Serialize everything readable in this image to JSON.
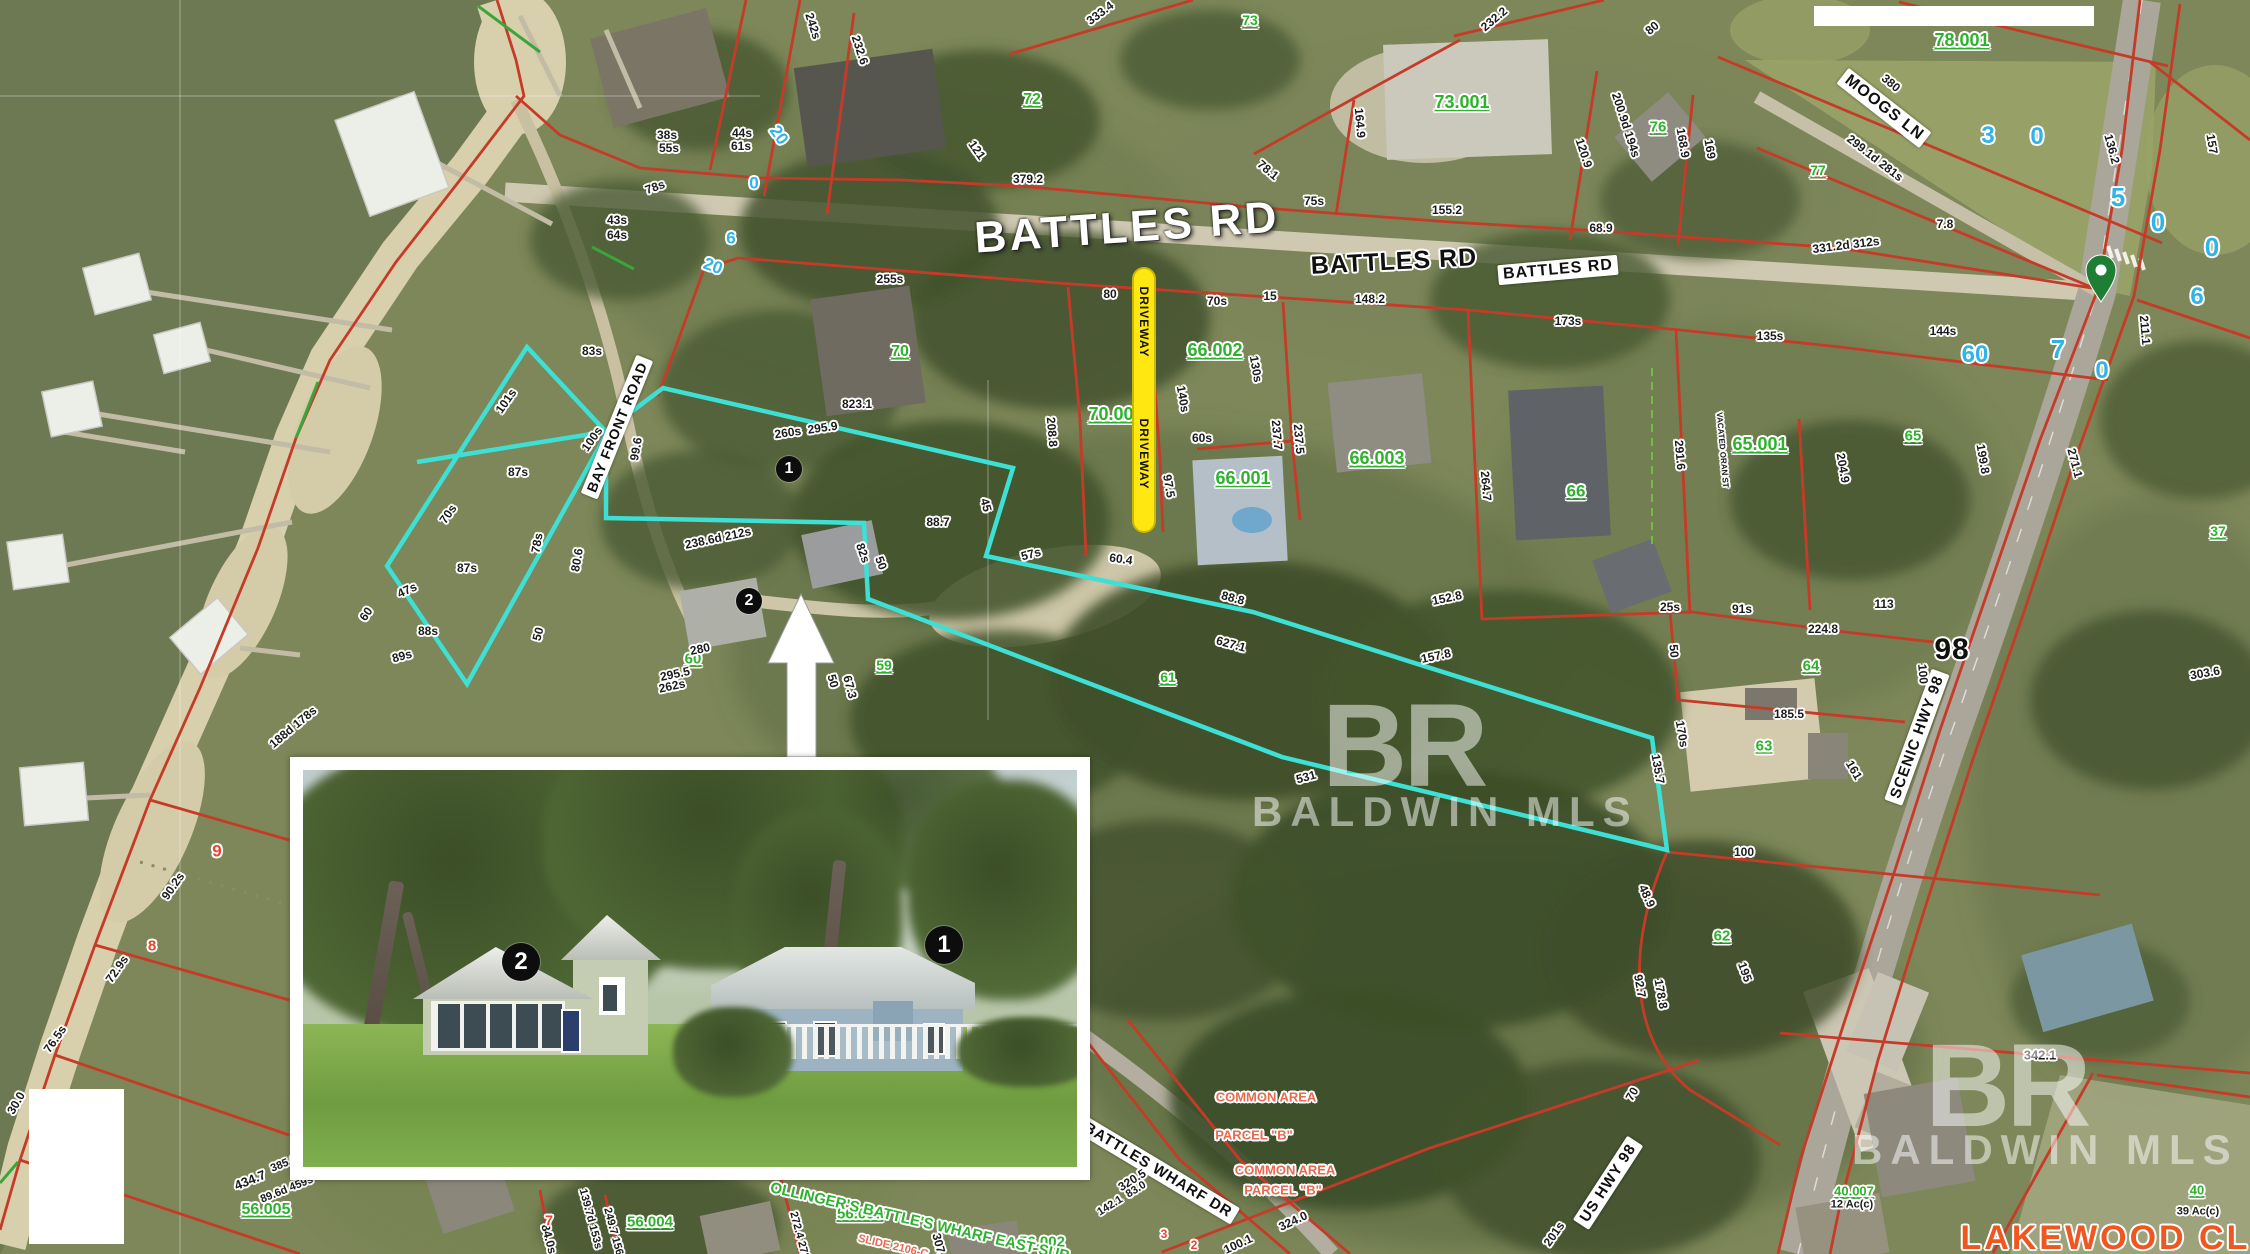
{
  "map": {
    "street_labels": [
      {
        "t": "BATTLES RD",
        "x": 1127,
        "y": 228,
        "r": -4,
        "s": 44,
        "k": "big"
      },
      {
        "t": "BATTLES RD",
        "x": 1394,
        "y": 262,
        "r": -3,
        "s": 25,
        "k": "halo"
      },
      {
        "t": "BATTLES RD",
        "x": 1558,
        "y": 270,
        "r": -5,
        "s": 16,
        "k": "box"
      },
      {
        "t": "MOOGS LN",
        "x": 1884,
        "y": 108,
        "r": 38,
        "s": 16,
        "k": "box"
      },
      {
        "t": "BAY FRONT ROAD",
        "x": 617,
        "y": 427,
        "r": -68,
        "s": 14,
        "k": "box"
      },
      {
        "t": "BATTLES WHARF DR",
        "x": 1158,
        "y": 1170,
        "r": 31,
        "s": 15,
        "k": "box"
      },
      {
        "t": "SCENIC HWY 98",
        "x": 1917,
        "y": 737,
        "r": -70,
        "s": 15,
        "k": "box"
      },
      {
        "t": "US HWY 98",
        "x": 1608,
        "y": 1183,
        "r": -57,
        "s": 15,
        "k": "box"
      },
      {
        "t": "98",
        "x": 1952,
        "y": 650,
        "r": 0,
        "s": 30,
        "k": "halo"
      }
    ],
    "parcel_numbers": [
      {
        "t": "73",
        "x": 1250,
        "y": 20,
        "s": 14
      },
      {
        "t": "72",
        "x": 1032,
        "y": 100,
        "s": 16
      },
      {
        "t": "73.001",
        "x": 1462,
        "y": 102,
        "s": 18
      },
      {
        "t": "76",
        "x": 1658,
        "y": 127,
        "s": 15
      },
      {
        "t": "77",
        "x": 1818,
        "y": 170,
        "s": 14
      },
      {
        "t": "78.001",
        "x": 1962,
        "y": 40,
        "s": 18
      },
      {
        "t": "70",
        "x": 900,
        "y": 352,
        "s": 16
      },
      {
        "t": "70.001",
        "x": 1116,
        "y": 414,
        "s": 18
      },
      {
        "t": "66.002",
        "x": 1215,
        "y": 350,
        "s": 18
      },
      {
        "t": "66.001",
        "x": 1243,
        "y": 478,
        "s": 18
      },
      {
        "t": "66.003",
        "x": 1377,
        "y": 458,
        "s": 18
      },
      {
        "t": "66",
        "x": 1576,
        "y": 491,
        "s": 17
      },
      {
        "t": "65.001",
        "x": 1760,
        "y": 444,
        "s": 18
      },
      {
        "t": "65",
        "x": 1913,
        "y": 436,
        "s": 15
      },
      {
        "t": "64",
        "x": 1811,
        "y": 666,
        "s": 15
      },
      {
        "t": "63",
        "x": 1764,
        "y": 746,
        "s": 15
      },
      {
        "t": "62",
        "x": 1722,
        "y": 936,
        "s": 15
      },
      {
        "t": "61",
        "x": 1168,
        "y": 677,
        "s": 14
      },
      {
        "t": "60",
        "x": 693,
        "y": 659,
        "s": 15
      },
      {
        "t": "59",
        "x": 884,
        "y": 665,
        "s": 14
      },
      {
        "t": "56.005",
        "x": 266,
        "y": 1210,
        "s": 16
      },
      {
        "t": "56.004",
        "x": 650,
        "y": 1222,
        "s": 15
      },
      {
        "t": "56.003",
        "x": 860,
        "y": 1214,
        "s": 15
      },
      {
        "t": "56.002",
        "x": 1042,
        "y": 1242,
        "s": 15
      },
      {
        "t": "40.007",
        "x": 1854,
        "y": 1191,
        "s": 13
      },
      {
        "t": "40",
        "x": 2197,
        "y": 1190,
        "s": 13
      },
      {
        "t": "37",
        "x": 2218,
        "y": 531,
        "s": 14
      }
    ],
    "subdivision_labels": [
      {
        "t": "OLLINGER'S BATTLE'S WHARF EAST SUB",
        "x": 920,
        "y": 1222,
        "r": 13,
        "s": 15,
        "c": "gs"
      },
      {
        "t": "SLIDE 2106-C",
        "x": 893,
        "y": 1247,
        "r": 13,
        "s": 11,
        "c": "o"
      }
    ],
    "dimension_labels": [
      {
        "t": "379.2",
        "x": 1028,
        "y": 179
      },
      {
        "t": "121",
        "x": 977,
        "y": 150,
        "r": 55
      },
      {
        "t": "255s",
        "x": 890,
        "y": 279
      },
      {
        "t": "80",
        "x": 1110,
        "y": 294
      },
      {
        "t": "70s",
        "x": 1217,
        "y": 301
      },
      {
        "t": "242s",
        "x": 813,
        "y": 26,
        "r": 72
      },
      {
        "t": "232.6",
        "x": 860,
        "y": 50,
        "r": 72
      },
      {
        "t": "333.4",
        "x": 1100,
        "y": 13,
        "r": -37
      },
      {
        "t": "38s",
        "x": 667,
        "y": 135
      },
      {
        "t": "55s",
        "x": 669,
        "y": 148
      },
      {
        "t": "44s",
        "x": 742,
        "y": 133
      },
      {
        "t": "61s",
        "x": 741,
        "y": 146
      },
      {
        "t": "43s",
        "x": 617,
        "y": 220
      },
      {
        "t": "64s",
        "x": 617,
        "y": 235
      },
      {
        "t": "78s",
        "x": 655,
        "y": 187,
        "r": -20
      },
      {
        "t": "75s",
        "x": 1314,
        "y": 201
      },
      {
        "t": "155.2",
        "x": 1447,
        "y": 210
      },
      {
        "t": "68.9",
        "x": 1601,
        "y": 228
      },
      {
        "t": "331.2d 312s",
        "x": 1846,
        "y": 245,
        "r": -7
      },
      {
        "t": "148.2",
        "x": 1370,
        "y": 299
      },
      {
        "t": "173s",
        "x": 1568,
        "y": 321
      },
      {
        "t": "135s",
        "x": 1770,
        "y": 336
      },
      {
        "t": "15",
        "x": 1270,
        "y": 296
      },
      {
        "t": "164.9",
        "x": 1360,
        "y": 123,
        "r": 85
      },
      {
        "t": "120.9",
        "x": 1584,
        "y": 153,
        "r": 72
      },
      {
        "t": "200.9d 194s",
        "x": 1626,
        "y": 125,
        "r": 72
      },
      {
        "t": "168.9",
        "x": 1683,
        "y": 143,
        "r": 80
      },
      {
        "t": "169",
        "x": 1710,
        "y": 149,
        "r": 80
      },
      {
        "t": "78.1",
        "x": 1268,
        "y": 170,
        "r": 40
      },
      {
        "t": "232.2",
        "x": 1494,
        "y": 19,
        "r": -40
      },
      {
        "t": "80",
        "x": 1652,
        "y": 28,
        "r": -40
      },
      {
        "t": "157",
        "x": 2212,
        "y": 144,
        "r": 80
      },
      {
        "t": "136.2",
        "x": 2112,
        "y": 149,
        "r": 75
      },
      {
        "t": "211.1",
        "x": 2145,
        "y": 330,
        "r": 85
      },
      {
        "t": "7.8",
        "x": 1945,
        "y": 224
      },
      {
        "t": "144s",
        "x": 1943,
        "y": 331
      },
      {
        "t": "380",
        "x": 1891,
        "y": 83,
        "r": 40
      },
      {
        "t": "299.1d 281s",
        "x": 1875,
        "y": 158,
        "r": 38
      },
      {
        "t": "208.8",
        "x": 1052,
        "y": 432,
        "r": 85
      },
      {
        "t": "140s",
        "x": 1183,
        "y": 399,
        "r": 80
      },
      {
        "t": "130s",
        "x": 1256,
        "y": 369,
        "r": 80
      },
      {
        "t": "237.7",
        "x": 1277,
        "y": 435,
        "r": 85
      },
      {
        "t": "237.5",
        "x": 1299,
        "y": 439,
        "r": 85
      },
      {
        "t": "60s",
        "x": 1202,
        "y": 438
      },
      {
        "t": "97.5",
        "x": 1169,
        "y": 486,
        "r": 80
      },
      {
        "t": "88.8",
        "x": 1233,
        "y": 598,
        "r": 15
      },
      {
        "t": "60.4",
        "x": 1121,
        "y": 559,
        "r": 8
      },
      {
        "t": "823.1",
        "x": 857,
        "y": 404
      },
      {
        "t": "260s  295.9",
        "x": 806,
        "y": 430,
        "r": -8
      },
      {
        "t": "238.6d 212s",
        "x": 718,
        "y": 538,
        "r": -12
      },
      {
        "t": "82s",
        "x": 863,
        "y": 553,
        "r": 70
      },
      {
        "t": "50",
        "x": 881,
        "y": 563,
        "r": 70
      },
      {
        "t": "88.7",
        "x": 938,
        "y": 522
      },
      {
        "t": "45",
        "x": 986,
        "y": 505,
        "r": 75
      },
      {
        "t": "57s",
        "x": 1031,
        "y": 554,
        "r": -15
      },
      {
        "t": "627.1",
        "x": 1231,
        "y": 644,
        "r": 15
      },
      {
        "t": "280",
        "x": 700,
        "y": 649,
        "r": -12
      },
      {
        "t": "295.5",
        "x": 675,
        "y": 674,
        "r": -12
      },
      {
        "t": "262s",
        "x": 672,
        "y": 686,
        "r": -12
      },
      {
        "t": "50",
        "x": 833,
        "y": 681,
        "r": 75
      },
      {
        "t": "67.3",
        "x": 850,
        "y": 687,
        "r": 75
      },
      {
        "t": "929.2",
        "x": 862,
        "y": 790,
        "r": -10
      },
      {
        "t": "152.8",
        "x": 1447,
        "y": 598,
        "r": -12
      },
      {
        "t": "157.8",
        "x": 1436,
        "y": 656,
        "r": -12
      },
      {
        "t": "531",
        "x": 1306,
        "y": 777,
        "r": -15
      },
      {
        "t": "83s",
        "x": 592,
        "y": 351
      },
      {
        "t": "101s",
        "x": 506,
        "y": 401,
        "r": -55
      },
      {
        "t": "100s",
        "x": 592,
        "y": 439,
        "r": -55
      },
      {
        "t": "99.6",
        "x": 636,
        "y": 449,
        "r": -80
      },
      {
        "t": "87s",
        "x": 518,
        "y": 472
      },
      {
        "t": "70s",
        "x": 448,
        "y": 514,
        "r": -55
      },
      {
        "t": "78s",
        "x": 537,
        "y": 543,
        "r": -80
      },
      {
        "t": "80.6",
        "x": 577,
        "y": 560,
        "r": -80
      },
      {
        "t": "87s",
        "x": 467,
        "y": 568
      },
      {
        "t": "47s",
        "x": 407,
        "y": 590,
        "r": -25
      },
      {
        "t": "88s",
        "x": 428,
        "y": 631
      },
      {
        "t": "50",
        "x": 538,
        "y": 634,
        "r": -75
      },
      {
        "t": "60",
        "x": 366,
        "y": 614,
        "r": -55
      },
      {
        "t": "89s",
        "x": 402,
        "y": 656,
        "r": -15
      },
      {
        "t": "188d 178s",
        "x": 293,
        "y": 727,
        "r": -40
      },
      {
        "t": "90.2s",
        "x": 173,
        "y": 886,
        "r": -55
      },
      {
        "t": "72.9s",
        "x": 117,
        "y": 969,
        "r": -55
      },
      {
        "t": "76.5s",
        "x": 55,
        "y": 1039,
        "r": -55
      },
      {
        "t": "30.0",
        "x": 16,
        "y": 1103,
        "r": -60
      },
      {
        "t": "385.6d 434s",
        "x": 300,
        "y": 1158,
        "r": -22,
        "s": 11
      },
      {
        "t": "434.7",
        "x": 250,
        "y": 1180,
        "r": -22,
        "s": 13
      },
      {
        "t": "89.6d 459s",
        "x": 287,
        "y": 1190,
        "r": -22,
        "s": 11
      },
      {
        "t": "291.6",
        "x": 1680,
        "y": 455,
        "r": 85
      },
      {
        "t": "264.7",
        "x": 1486,
        "y": 486,
        "r": 85
      },
      {
        "t": "204.9",
        "x": 1843,
        "y": 468,
        "r": 80
      },
      {
        "t": "91s",
        "x": 1742,
        "y": 609
      },
      {
        "t": "25s",
        "x": 1670,
        "y": 607
      },
      {
        "t": "224.8",
        "x": 1823,
        "y": 629
      },
      {
        "t": "113",
        "x": 1884,
        "y": 604
      },
      {
        "t": "50",
        "x": 1674,
        "y": 651,
        "r": 85
      },
      {
        "t": "185.5",
        "x": 1789,
        "y": 714
      },
      {
        "t": "100",
        "x": 1923,
        "y": 674,
        "r": 85
      },
      {
        "t": "161",
        "x": 1854,
        "y": 770,
        "r": 60
      },
      {
        "t": "199.8",
        "x": 1983,
        "y": 459,
        "r": 80
      },
      {
        "t": "271.1",
        "x": 2075,
        "y": 463,
        "r": 75
      },
      {
        "t": "303.6",
        "x": 2205,
        "y": 673,
        "r": -10
      },
      {
        "t": "VACATED ORAN ST",
        "x": 1722,
        "y": 450,
        "r": 85,
        "s": 8
      },
      {
        "t": "135.7",
        "x": 1658,
        "y": 769,
        "r": 80
      },
      {
        "t": "170s",
        "x": 1682,
        "y": 734,
        "r": 80
      },
      {
        "t": "100",
        "x": 1744,
        "y": 852
      },
      {
        "t": "48.9",
        "x": 1647,
        "y": 896,
        "r": 65
      },
      {
        "t": "92.7",
        "x": 1640,
        "y": 986,
        "r": 80
      },
      {
        "t": "178.8",
        "x": 1661,
        "y": 994,
        "r": 80
      },
      {
        "t": "195",
        "x": 1745,
        "y": 972,
        "r": 70
      },
      {
        "t": "342.1",
        "x": 2040,
        "y": 1055,
        "s": 13
      },
      {
        "t": "12 Ac(c)",
        "x": 1852,
        "y": 1205,
        "s": 11
      },
      {
        "t": "39 Ac(c)",
        "x": 2198,
        "y": 1212,
        "s": 11
      },
      {
        "t": "320.5",
        "x": 1132,
        "y": 1180,
        "r": -32
      },
      {
        "t": "142.1  83.0",
        "x": 1122,
        "y": 1199,
        "r": -32,
        "s": 11
      },
      {
        "t": "100.1",
        "x": 1238,
        "y": 1244,
        "r": -25
      },
      {
        "t": "324.0",
        "x": 1293,
        "y": 1221,
        "r": -25
      },
      {
        "t": "201s",
        "x": 1554,
        "y": 1234,
        "r": -55
      },
      {
        "t": "84.0s",
        "x": 549,
        "y": 1239,
        "r": 75
      },
      {
        "t": "139.7d 153s",
        "x": 590,
        "y": 1219,
        "r": 75,
        "s": 11
      },
      {
        "t": "249.7 156.6",
        "x": 614,
        "y": 1236,
        "r": 75,
        "s": 11
      },
      {
        "t": "272.4 272.9",
        "x": 800,
        "y": 1240,
        "r": 75,
        "s": 11
      },
      {
        "t": "307.9",
        "x": 940,
        "y": 1248,
        "r": 75
      },
      {
        "t": "70",
        "x": 1632,
        "y": 1094,
        "r": -60
      }
    ],
    "address_numbers_blue": [
      {
        "t": "20",
        "x": 779,
        "y": 135,
        "r": 55,
        "s": 17
      },
      {
        "t": "0",
        "x": 754,
        "y": 183,
        "s": 17
      },
      {
        "t": "6",
        "x": 731,
        "y": 238,
        "s": 17
      },
      {
        "t": "20",
        "x": 713,
        "y": 266,
        "r": 20,
        "s": 17
      },
      {
        "t": "3",
        "x": 1988,
        "y": 136,
        "s": 24
      },
      {
        "t": "0",
        "x": 2037,
        "y": 137,
        "s": 24
      },
      {
        "t": "5",
        "x": 2118,
        "y": 197,
        "s": 26
      },
      {
        "t": "0",
        "x": 2158,
        "y": 222,
        "s": 26
      },
      {
        "t": "0",
        "x": 2212,
        "y": 247,
        "s": 26
      },
      {
        "t": "6",
        "x": 2197,
        "y": 297,
        "s": 24
      },
      {
        "t": "60",
        "x": 1975,
        "y": 355,
        "s": 24
      },
      {
        "t": "7",
        "x": 2058,
        "y": 349,
        "s": 26
      },
      {
        "t": "0",
        "x": 2102,
        "y": 371,
        "s": 24
      }
    ],
    "lot_numbers_red": [
      {
        "t": "9",
        "x": 217,
        "y": 851,
        "s": 17
      },
      {
        "t": "8",
        "x": 152,
        "y": 946,
        "s": 15
      },
      {
        "t": "7",
        "x": 549,
        "y": 1220,
        "s": 14
      },
      {
        "t": "3",
        "x": 1164,
        "y": 1234,
        "s": 12
      },
      {
        "t": "2",
        "x": 1194,
        "y": 1245,
        "s": 12
      }
    ],
    "area_labels_orange": [
      {
        "t": "COMMON AREA",
        "x": 1266,
        "y": 1097,
        "s": 13
      },
      {
        "t": "PARCEL \"B\"",
        "x": 1254,
        "y": 1135,
        "s": 13
      },
      {
        "t": "COMMON AREA",
        "x": 1285,
        "y": 1170,
        "s": 13
      },
      {
        "t": "PARCEL \"B\"",
        "x": 1283,
        "y": 1190,
        "s": 13
      }
    ],
    "big_label_orange": {
      "t": "LAKEWOOD CLUB",
      "x": 2133,
      "y": 1238,
      "s": 34
    },
    "driveway_callout": {
      "label": "DRIVEWAY"
    },
    "markers_map": [
      {
        "n": "1",
        "x": 789,
        "y": 469,
        "d": 26
      },
      {
        "n": "2",
        "x": 749,
        "y": 601,
        "d": 26
      }
    ],
    "markers_photo": [
      {
        "n": "2",
        "x": 521,
        "y": 962,
        "d": 38
      },
      {
        "n": "1",
        "x": 944,
        "y": 945,
        "d": 38
      }
    ],
    "watermark": {
      "initials": "BR",
      "name": "BALDWIN MLS"
    },
    "colors": {
      "parcel_line_red": "#c63b28",
      "subject_outline_cyan": "#3ee0d5",
      "driveway_yellow": "#ffe712",
      "parcel_number_green": "#2eb22e",
      "address_blue": "#2fb3e8",
      "lot_red": "#e8452e",
      "area_orange": "#e86a50",
      "lakewood_orange": "#f0561f",
      "water_olive": "#6b7750",
      "map_pin_green": "#1e7e34"
    }
  }
}
